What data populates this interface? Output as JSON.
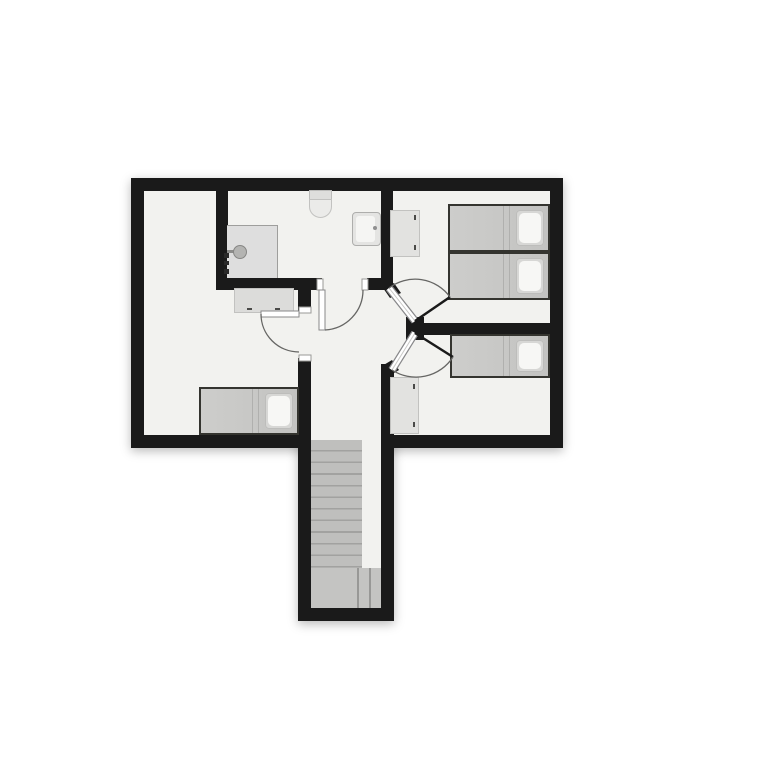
{
  "plan": {
    "type": "floor-plan",
    "description": "Upper floor plan: bathroom with shower, sink and toilet; two bedrooms on the right with single beds; one bedroom on the left; central hallway with staircase leading down",
    "colors": {
      "wall": "#1a1a1a",
      "floor": "#f2f2ef",
      "background": "#ffffff",
      "mattress": "#c7c7c5",
      "pillow": "#f7f7f5",
      "cabinet": "#e2e2e0",
      "stairs": "#bfbfbd",
      "landing": "#c4c4c2",
      "shower": "#dedede",
      "door_arc": "#666666"
    },
    "rooms": [
      {
        "id": "bathroom",
        "position": "top-middle",
        "fixtures": [
          "toilet",
          "sink",
          "shower"
        ]
      },
      {
        "id": "bedroom-top-right",
        "furniture": [
          "dresser",
          "single-bed",
          "single-bed"
        ]
      },
      {
        "id": "bedroom-middle-right",
        "furniture": [
          "single-bed",
          "wardrobe"
        ]
      },
      {
        "id": "bedroom-left",
        "furniture": [
          "dresser",
          "single-bed"
        ]
      },
      {
        "id": "hallway",
        "features": [
          "staircase-down"
        ]
      }
    ],
    "counts": {
      "beds": 4,
      "doors": 4,
      "cabinets": 3
    },
    "staircase": {
      "treads": 11,
      "landing": true,
      "direction": "down"
    }
  }
}
